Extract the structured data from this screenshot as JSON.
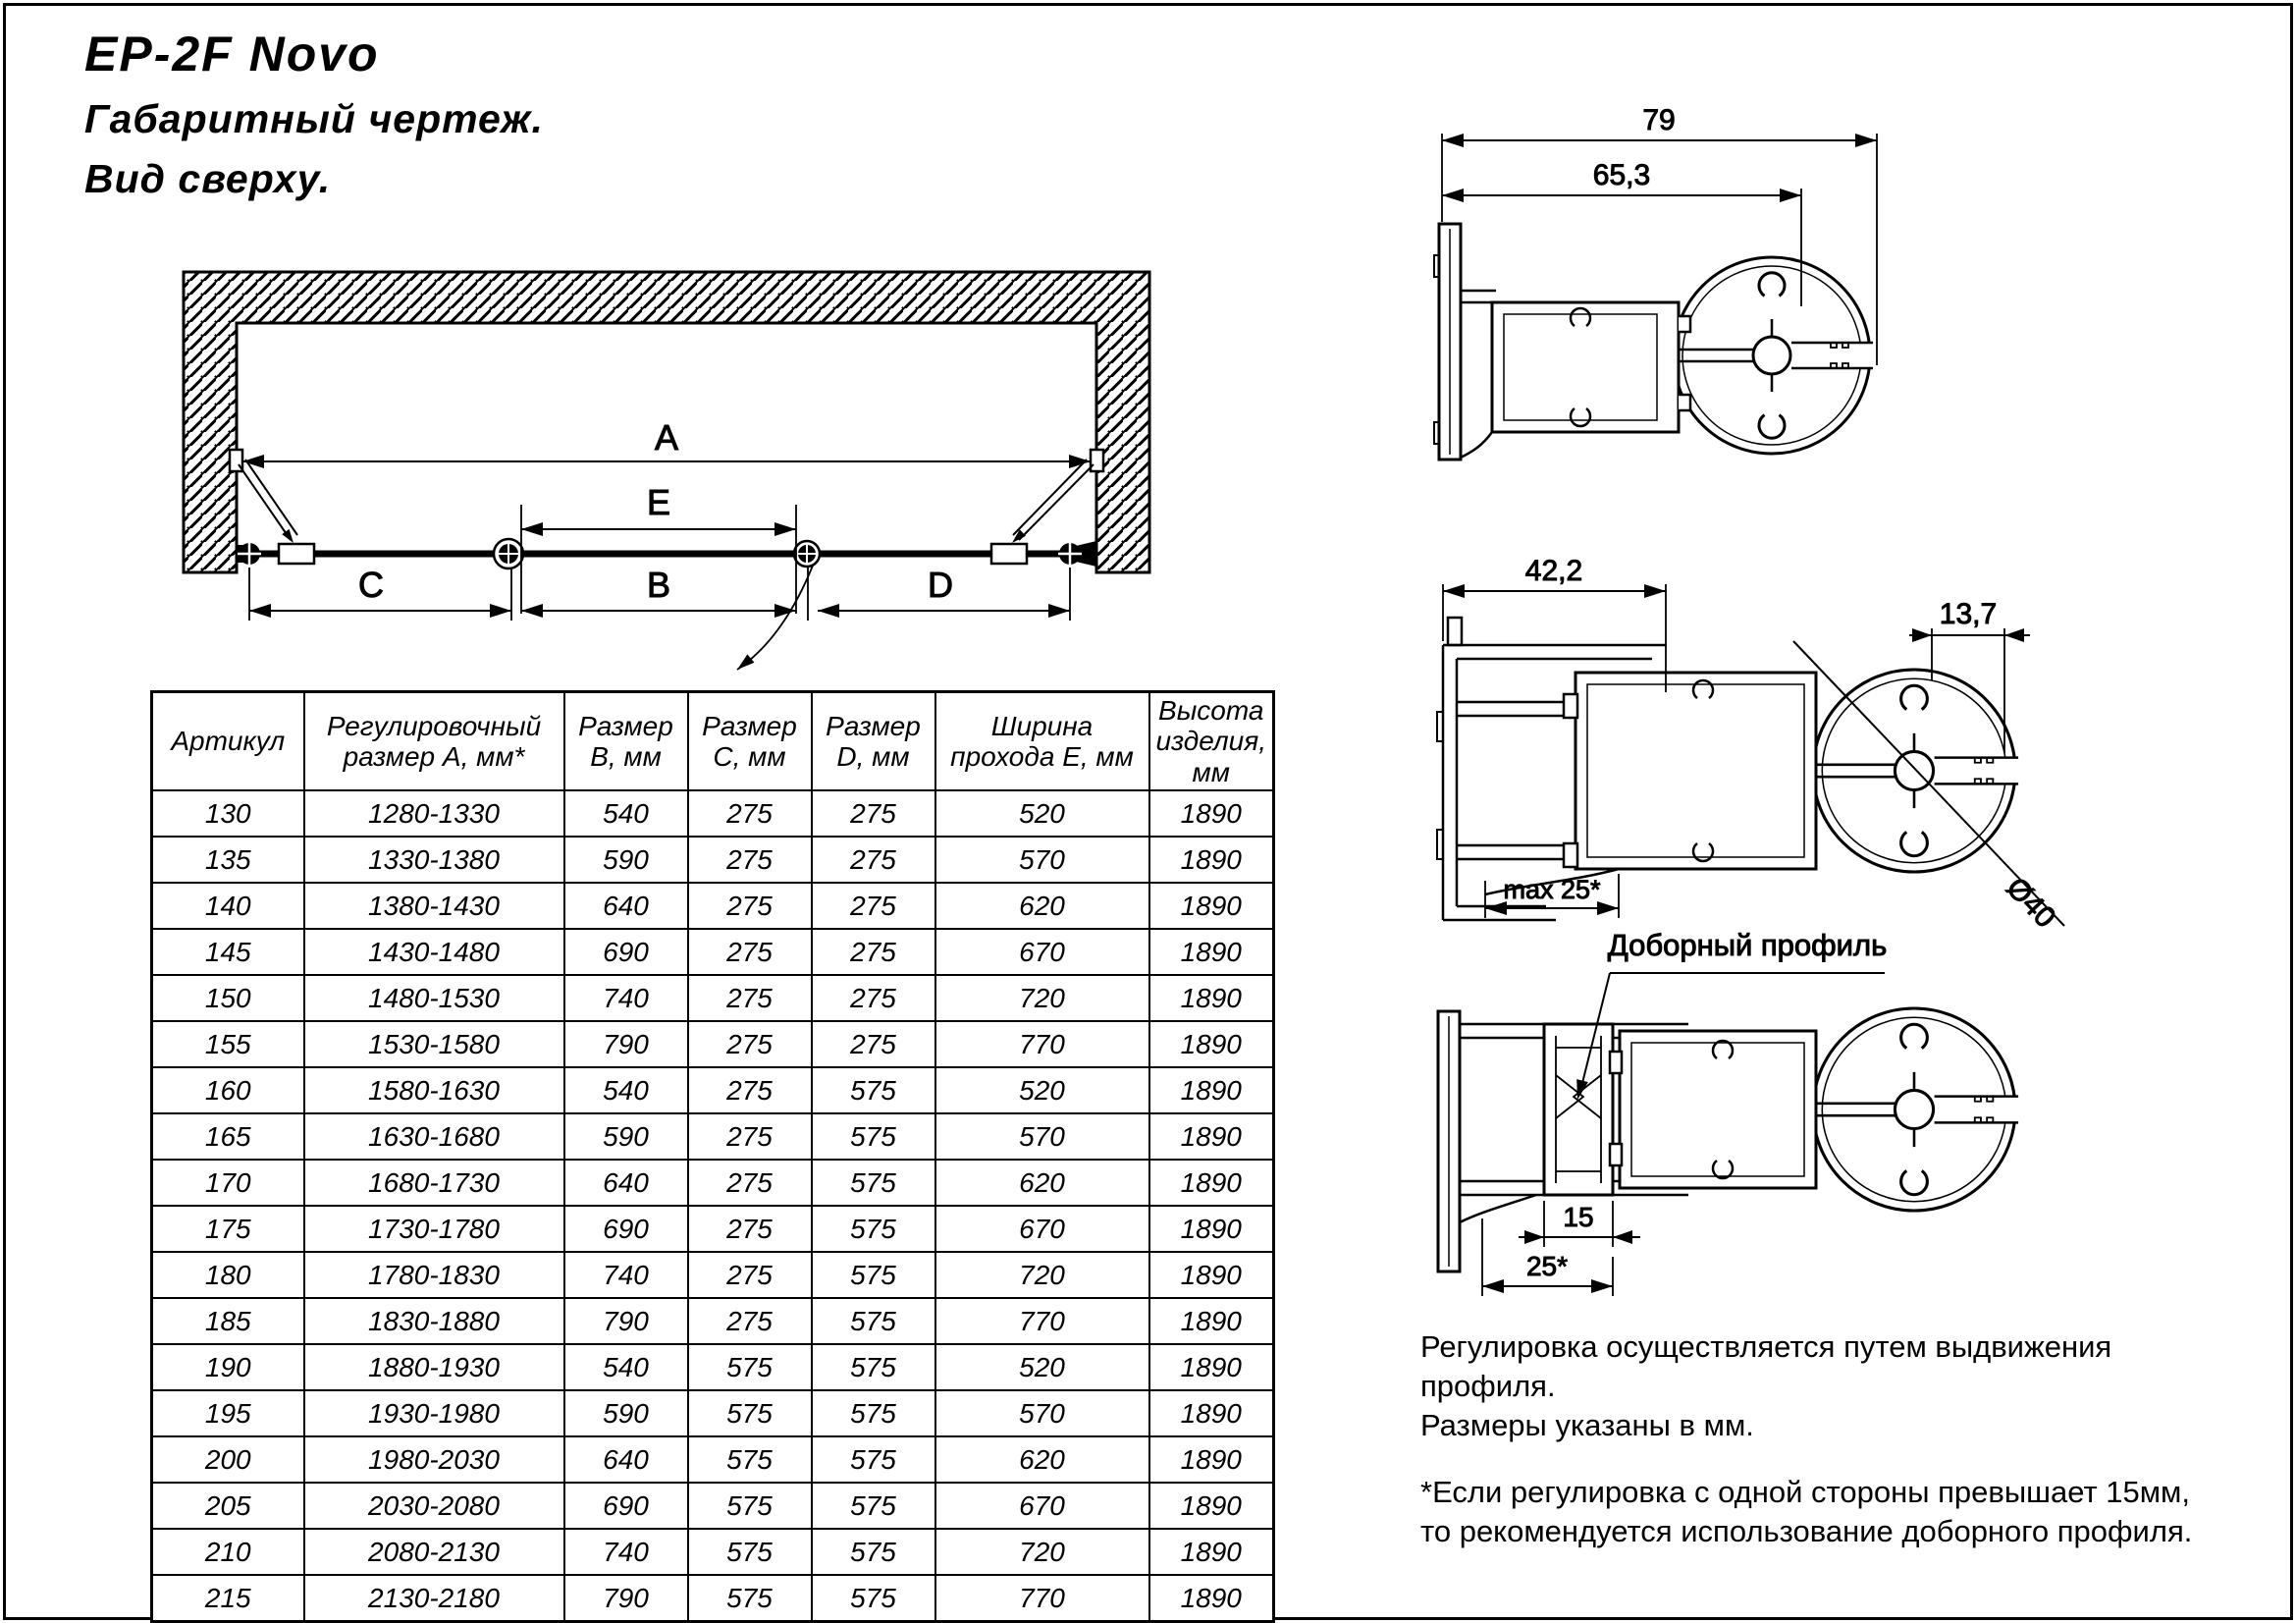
{
  "title": "EP-2F Novo",
  "subtitle_line1": "Габаритный чертеж.",
  "subtitle_line2": "Вид сверху.",
  "top_view": {
    "dim_a": "A",
    "dim_e": "E",
    "dim_c": "C",
    "dim_b": "B",
    "dim_d": "D"
  },
  "table": {
    "columns": [
      "Артикул",
      "Регулировочный размер А, мм*",
      "Размер В, мм",
      "Размер С, мм",
      "Размер D, мм",
      "Ширина прохода Е, мм",
      "Высота изделия, мм"
    ],
    "rows": [
      [
        "130",
        "1280-1330",
        "540",
        "275",
        "275",
        "520",
        "1890"
      ],
      [
        "135",
        "1330-1380",
        "590",
        "275",
        "275",
        "570",
        "1890"
      ],
      [
        "140",
        "1380-1430",
        "640",
        "275",
        "275",
        "620",
        "1890"
      ],
      [
        "145",
        "1430-1480",
        "690",
        "275",
        "275",
        "670",
        "1890"
      ],
      [
        "150",
        "1480-1530",
        "740",
        "275",
        "275",
        "720",
        "1890"
      ],
      [
        "155",
        "1530-1580",
        "790",
        "275",
        "275",
        "770",
        "1890"
      ],
      [
        "160",
        "1580-1630",
        "540",
        "275",
        "575",
        "520",
        "1890"
      ],
      [
        "165",
        "1630-1680",
        "590",
        "275",
        "575",
        "570",
        "1890"
      ],
      [
        "170",
        "1680-1730",
        "640",
        "275",
        "575",
        "620",
        "1890"
      ],
      [
        "175",
        "1730-1780",
        "690",
        "275",
        "575",
        "670",
        "1890"
      ],
      [
        "180",
        "1780-1830",
        "740",
        "275",
        "575",
        "720",
        "1890"
      ],
      [
        "185",
        "1830-1880",
        "790",
        "275",
        "575",
        "770",
        "1890"
      ],
      [
        "190",
        "1880-1930",
        "540",
        "575",
        "575",
        "520",
        "1890"
      ],
      [
        "195",
        "1930-1980",
        "590",
        "575",
        "575",
        "570",
        "1890"
      ],
      [
        "200",
        "1980-2030",
        "640",
        "575",
        "575",
        "620",
        "1890"
      ],
      [
        "205",
        "2030-2080",
        "690",
        "575",
        "575",
        "670",
        "1890"
      ],
      [
        "210",
        "2080-2130",
        "740",
        "575",
        "575",
        "720",
        "1890"
      ],
      [
        "215",
        "2130-2180",
        "790",
        "575",
        "575",
        "770",
        "1890"
      ]
    ]
  },
  "profile_top": {
    "dim_overall": "79",
    "dim_inner": "65,3"
  },
  "profile_middle": {
    "dim_wall": "42,2",
    "dim_gap": "13,7",
    "dim_max": "max 25*",
    "dim_diameter": "Ø40"
  },
  "profile_bottom": {
    "callout": "Доборный профиль",
    "dim_insert": "15",
    "dim_range": "25*"
  },
  "notes": {
    "adjustment_line1": "Регулировка осуществляется путем выдвижения профиля.",
    "adjustment_line2": "Размеры указаны в мм.",
    "footnote_line1": "*Если регулировка с одной стороны превышает 15мм,",
    "footnote_line2": "то рекомендуется использование доборного профиля."
  },
  "colors": {
    "line": "#000000",
    "background": "#ffffff"
  }
}
